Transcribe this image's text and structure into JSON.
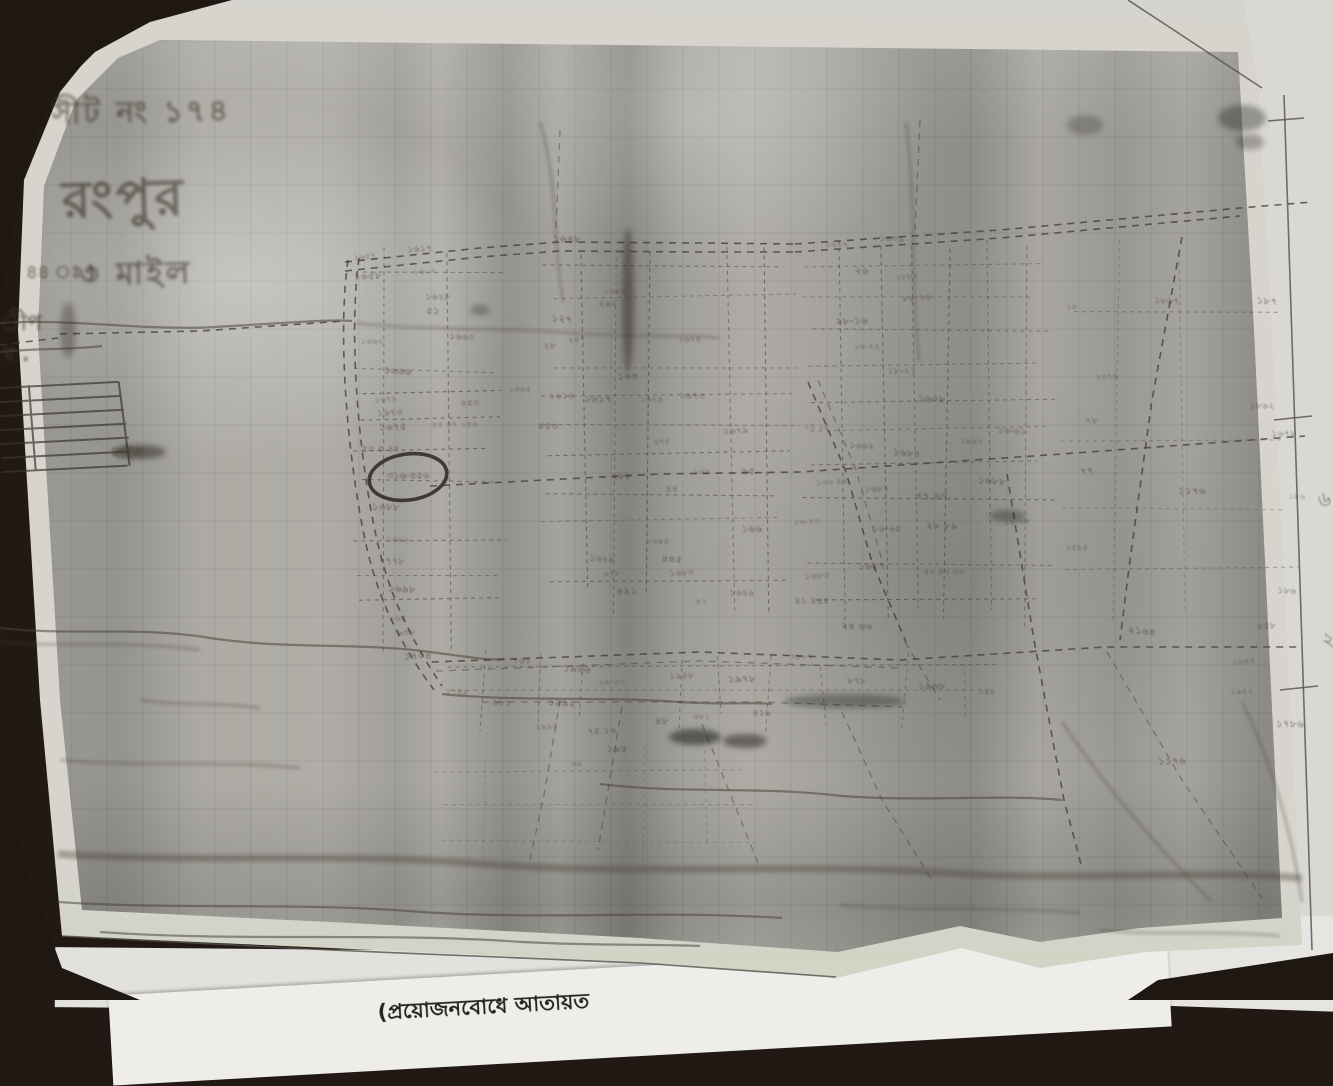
{
  "annotations": {
    "sheet_no": "সীট নং ১৭৪",
    "place_name": "রংপুর",
    "scale_note": "৩ মাইল",
    "scale_prefix": "৪৪ ঃ )",
    "margin_fragment_1": "ীপ",
    "margin_fragment_2": "র .",
    "scale_bar_label": "মাইল",
    "circled_plot_no": "৩১৬-৪৫৬",
    "right_margin_mark_1": "৬",
    "right_margin_mark_2": "২"
  },
  "under_sheet": {
    "printed_text": "(প্রয়োজনবোধে আতায়ত"
  },
  "colors": {
    "table_surface": "#1f1712",
    "sheet_paper": "#d6d4cd",
    "map_grey": "#b3b1aa",
    "ink": "#3b362e",
    "pen_circle": "#2b2721",
    "bottom_margin_tint": "#c4d6b6"
  },
  "plot_numbers": [
    [
      365,
      257,
      "১৬৫৭"
    ],
    [
      420,
      250,
      "১৬১৭"
    ],
    [
      368,
      277,
      "১৬৫৮"
    ],
    [
      425,
      272,
      "১৬০৭"
    ],
    [
      438,
      298,
      "১৬২৮"
    ],
    [
      433,
      312,
      "৫১"
    ],
    [
      372,
      342,
      "১৬৬৩"
    ],
    [
      462,
      338,
      "১৬৬০"
    ],
    [
      398,
      372,
      "১৬৬৬"
    ],
    [
      386,
      400,
      "১৬৭২"
    ],
    [
      390,
      414,
      "১৬৭৩"
    ],
    [
      393,
      428,
      "১৬৭৫"
    ],
    [
      455,
      425,
      "৪৫ ৪৭ ১৪৬"
    ],
    [
      381,
      450,
      "৫৩ ৫ ৪৭"
    ],
    [
      386,
      508,
      "১৬৮৮"
    ],
    [
      398,
      540,
      "১৬৯২"
    ],
    [
      392,
      562,
      "২৭৭৮"
    ],
    [
      402,
      590,
      "১৬৯৮"
    ],
    [
      398,
      619,
      "১৬৪"
    ],
    [
      406,
      634,
      "৬৩৮"
    ],
    [
      418,
      657,
      "১৭০৪"
    ],
    [
      520,
      390,
      "১৩৬৫"
    ],
    [
      470,
      404,
      "৪৫৩"
    ],
    [
      567,
      240,
      "১৬৪৮"
    ],
    [
      615,
      292,
      "১৬৪৩"
    ],
    [
      608,
      305,
      "২৬২"
    ],
    [
      562,
      320,
      "১২৭"
    ],
    [
      577,
      340,
      "২৪৭"
    ],
    [
      550,
      347,
      "২৮"
    ],
    [
      628,
      377,
      "১৬৪"
    ],
    [
      690,
      340,
      "১৬২৫"
    ],
    [
      562,
      397,
      "১৬১৬"
    ],
    [
      598,
      400,
      "১৬১৭"
    ],
    [
      652,
      400,
      "১৬৭৪"
    ],
    [
      692,
      397,
      "১৬৭৩"
    ],
    [
      548,
      427,
      "৪৫৩"
    ],
    [
      662,
      442,
      "৬৭৪"
    ],
    [
      736,
      432,
      "১৬৭৯"
    ],
    [
      622,
      477,
      "২৮৮"
    ],
    [
      702,
      472,
      "১৬৮"
    ],
    [
      672,
      490,
      "৪৪"
    ],
    [
      748,
      472,
      "৬৫"
    ],
    [
      658,
      542,
      "১৬৪৫"
    ],
    [
      602,
      560,
      "১৬২৯"
    ],
    [
      672,
      560,
      "৪৪৫"
    ],
    [
      612,
      574,
      "৬৭৮"
    ],
    [
      682,
      574,
      "১৬৮০"
    ],
    [
      627,
      592,
      "৪২১"
    ],
    [
      702,
      602,
      "৮১"
    ],
    [
      742,
      594,
      "১৬৪৯"
    ],
    [
      752,
      530,
      "১৬৬"
    ],
    [
      837,
      245,
      "১৬১৭"
    ],
    [
      892,
      240,
      "১৬০৯"
    ],
    [
      862,
      272,
      "২৬"
    ],
    [
      907,
      277,
      "১৮৮২"
    ],
    [
      917,
      299,
      "৮৮ ৭৪"
    ],
    [
      852,
      322,
      "২৮-১৬"
    ],
    [
      867,
      347,
      "১৬-২২"
    ],
    [
      902,
      372,
      "১৮-২১"
    ],
    [
      932,
      400,
      "১৬০৮"
    ],
    [
      817,
      427,
      "১৫ ১৫"
    ],
    [
      862,
      447,
      "১৬৬২"
    ],
    [
      907,
      454,
      "১৬৮৭"
    ],
    [
      832,
      482,
      "১৬৬ ৪২"
    ],
    [
      877,
      490,
      "১৬৮১"
    ],
    [
      932,
      497,
      "৭৭ ৬৩"
    ],
    [
      807,
      522,
      "১৬-৭৩"
    ],
    [
      887,
      530,
      "১৬-৬৫"
    ],
    [
      942,
      527,
      "২৮ ৮৯"
    ],
    [
      972,
      442,
      "১৮৬৭"
    ],
    [
      1012,
      432,
      "১৬-৬১"
    ],
    [
      992,
      482,
      "১৬৮৮"
    ],
    [
      1017,
      522,
      "১৬-৬৮"
    ],
    [
      817,
      577,
      "১৬৮৩"
    ],
    [
      872,
      567,
      "১৬৮৭"
    ],
    [
      944,
      572,
      "৪২ ৪৬ ৬৬"
    ],
    [
      812,
      602,
      "৪১ ৪৪৫"
    ],
    [
      857,
      627,
      "২৪ ৬৬"
    ],
    [
      1072,
      307,
      "১৮"
    ],
    [
      1167,
      302,
      "১৮৬৭"
    ],
    [
      1267,
      302,
      "১৮৭"
    ],
    [
      1107,
      377,
      "২৩৭৬"
    ],
    [
      1092,
      422,
      "৭৮"
    ],
    [
      1087,
      472,
      "৭৭"
    ],
    [
      1077,
      548,
      "১৫৯৪"
    ],
    [
      1262,
      407,
      "১৮৬২"
    ],
    [
      1192,
      492,
      "১১৭৬"
    ],
    [
      1297,
      497,
      "১৮৬"
    ],
    [
      1287,
      592,
      "১৮৬"
    ],
    [
      1142,
      632,
      "২১৬৪"
    ],
    [
      1244,
      662,
      "১৬৪২"
    ],
    [
      1267,
      627,
      "৮৫৮"
    ],
    [
      1172,
      762,
      "১১৭৬"
    ],
    [
      1242,
      692,
      "১৯৫২"
    ],
    [
      1284,
      435,
      "১৬৭৮"
    ],
    [
      1290,
      725,
      "১৭৮৬"
    ],
    [
      457,
      692,
      "১৭৪৯"
    ],
    [
      522,
      662,
      "৭৬২"
    ],
    [
      577,
      670,
      "১৯৬৬"
    ],
    [
      612,
      682,
      "১৯-১০"
    ],
    [
      682,
      677,
      "১৯৪৮"
    ],
    [
      742,
      680,
      "১৯৭৮"
    ],
    [
      802,
      657,
      "২৮০২"
    ],
    [
      857,
      682,
      "৮৭৮"
    ],
    [
      932,
      687,
      "১৯৬৮"
    ],
    [
      987,
      692,
      "১৯৪"
    ],
    [
      502,
      704,
      "৬৮১"
    ],
    [
      562,
      704,
      "১৯৯২"
    ],
    [
      547,
      727,
      "১৯৯৫"
    ],
    [
      602,
      732,
      "৭৫ ১৬"
    ],
    [
      662,
      722,
      "৪৮"
    ],
    [
      702,
      717,
      "৬৮১"
    ],
    [
      762,
      714,
      "৪১৯"
    ],
    [
      617,
      750,
      "১৯৫"
    ],
    [
      577,
      764,
      "৬৯"
    ]
  ]
}
